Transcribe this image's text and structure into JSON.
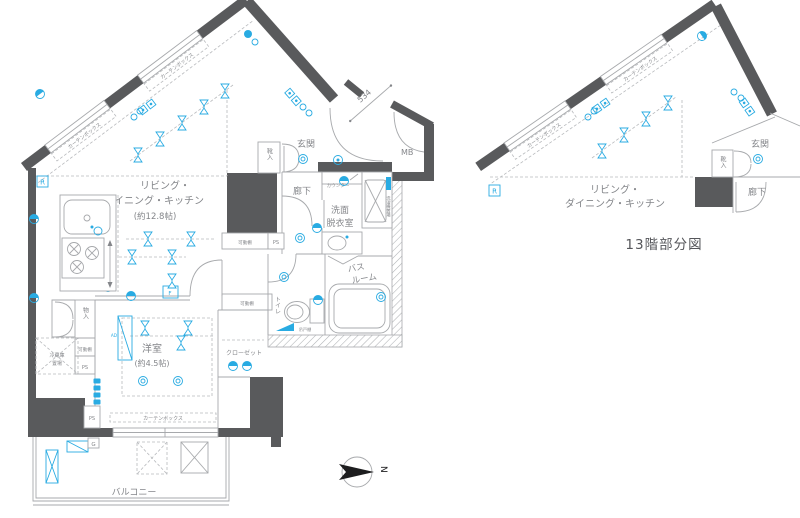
{
  "caption": "13階部分図",
  "compass": {
    "north": "N"
  },
  "dimensions": {
    "entry": "534"
  },
  "colors": {
    "wall": "#595a5c",
    "line": "#a7a9ac",
    "accent": "#29abe2",
    "label_text": "#84868a"
  },
  "rooms": {
    "ldk_line1": "リビング・",
    "ldk_line2": "ダイニング・キッチン",
    "ldk_size": "(約12.8帖)",
    "bedroom": "洋室",
    "bedroom_size": "(約4.5帖)",
    "entrance": "玄関",
    "hallway": "廊下",
    "washroom_line1": "洗面",
    "washroom_line2": "脱衣室",
    "bathroom_line1": "バス",
    "bathroom_line2": "ルーム",
    "toilet": "トイレ",
    "balcony": "バルコニー",
    "closet": "クローゼット"
  },
  "fixtures": {
    "storage": "物入",
    "shoe_cabinet": "靴入",
    "fridge_line1": "冷蔵庫",
    "fridge_line2": "置場",
    "counter": "カウンター",
    "hanging_cabinet": "吊戸棚",
    "laundry_space": "洗濯機置場",
    "movable_shelf": "可動棚",
    "pipe_space": "PS",
    "meter_box": "MB",
    "curtain_box": "カーテンボックス",
    "air_duct": "AD",
    "floor_hatch": "F",
    "g_mark": "G",
    "r_mark": "R"
  }
}
